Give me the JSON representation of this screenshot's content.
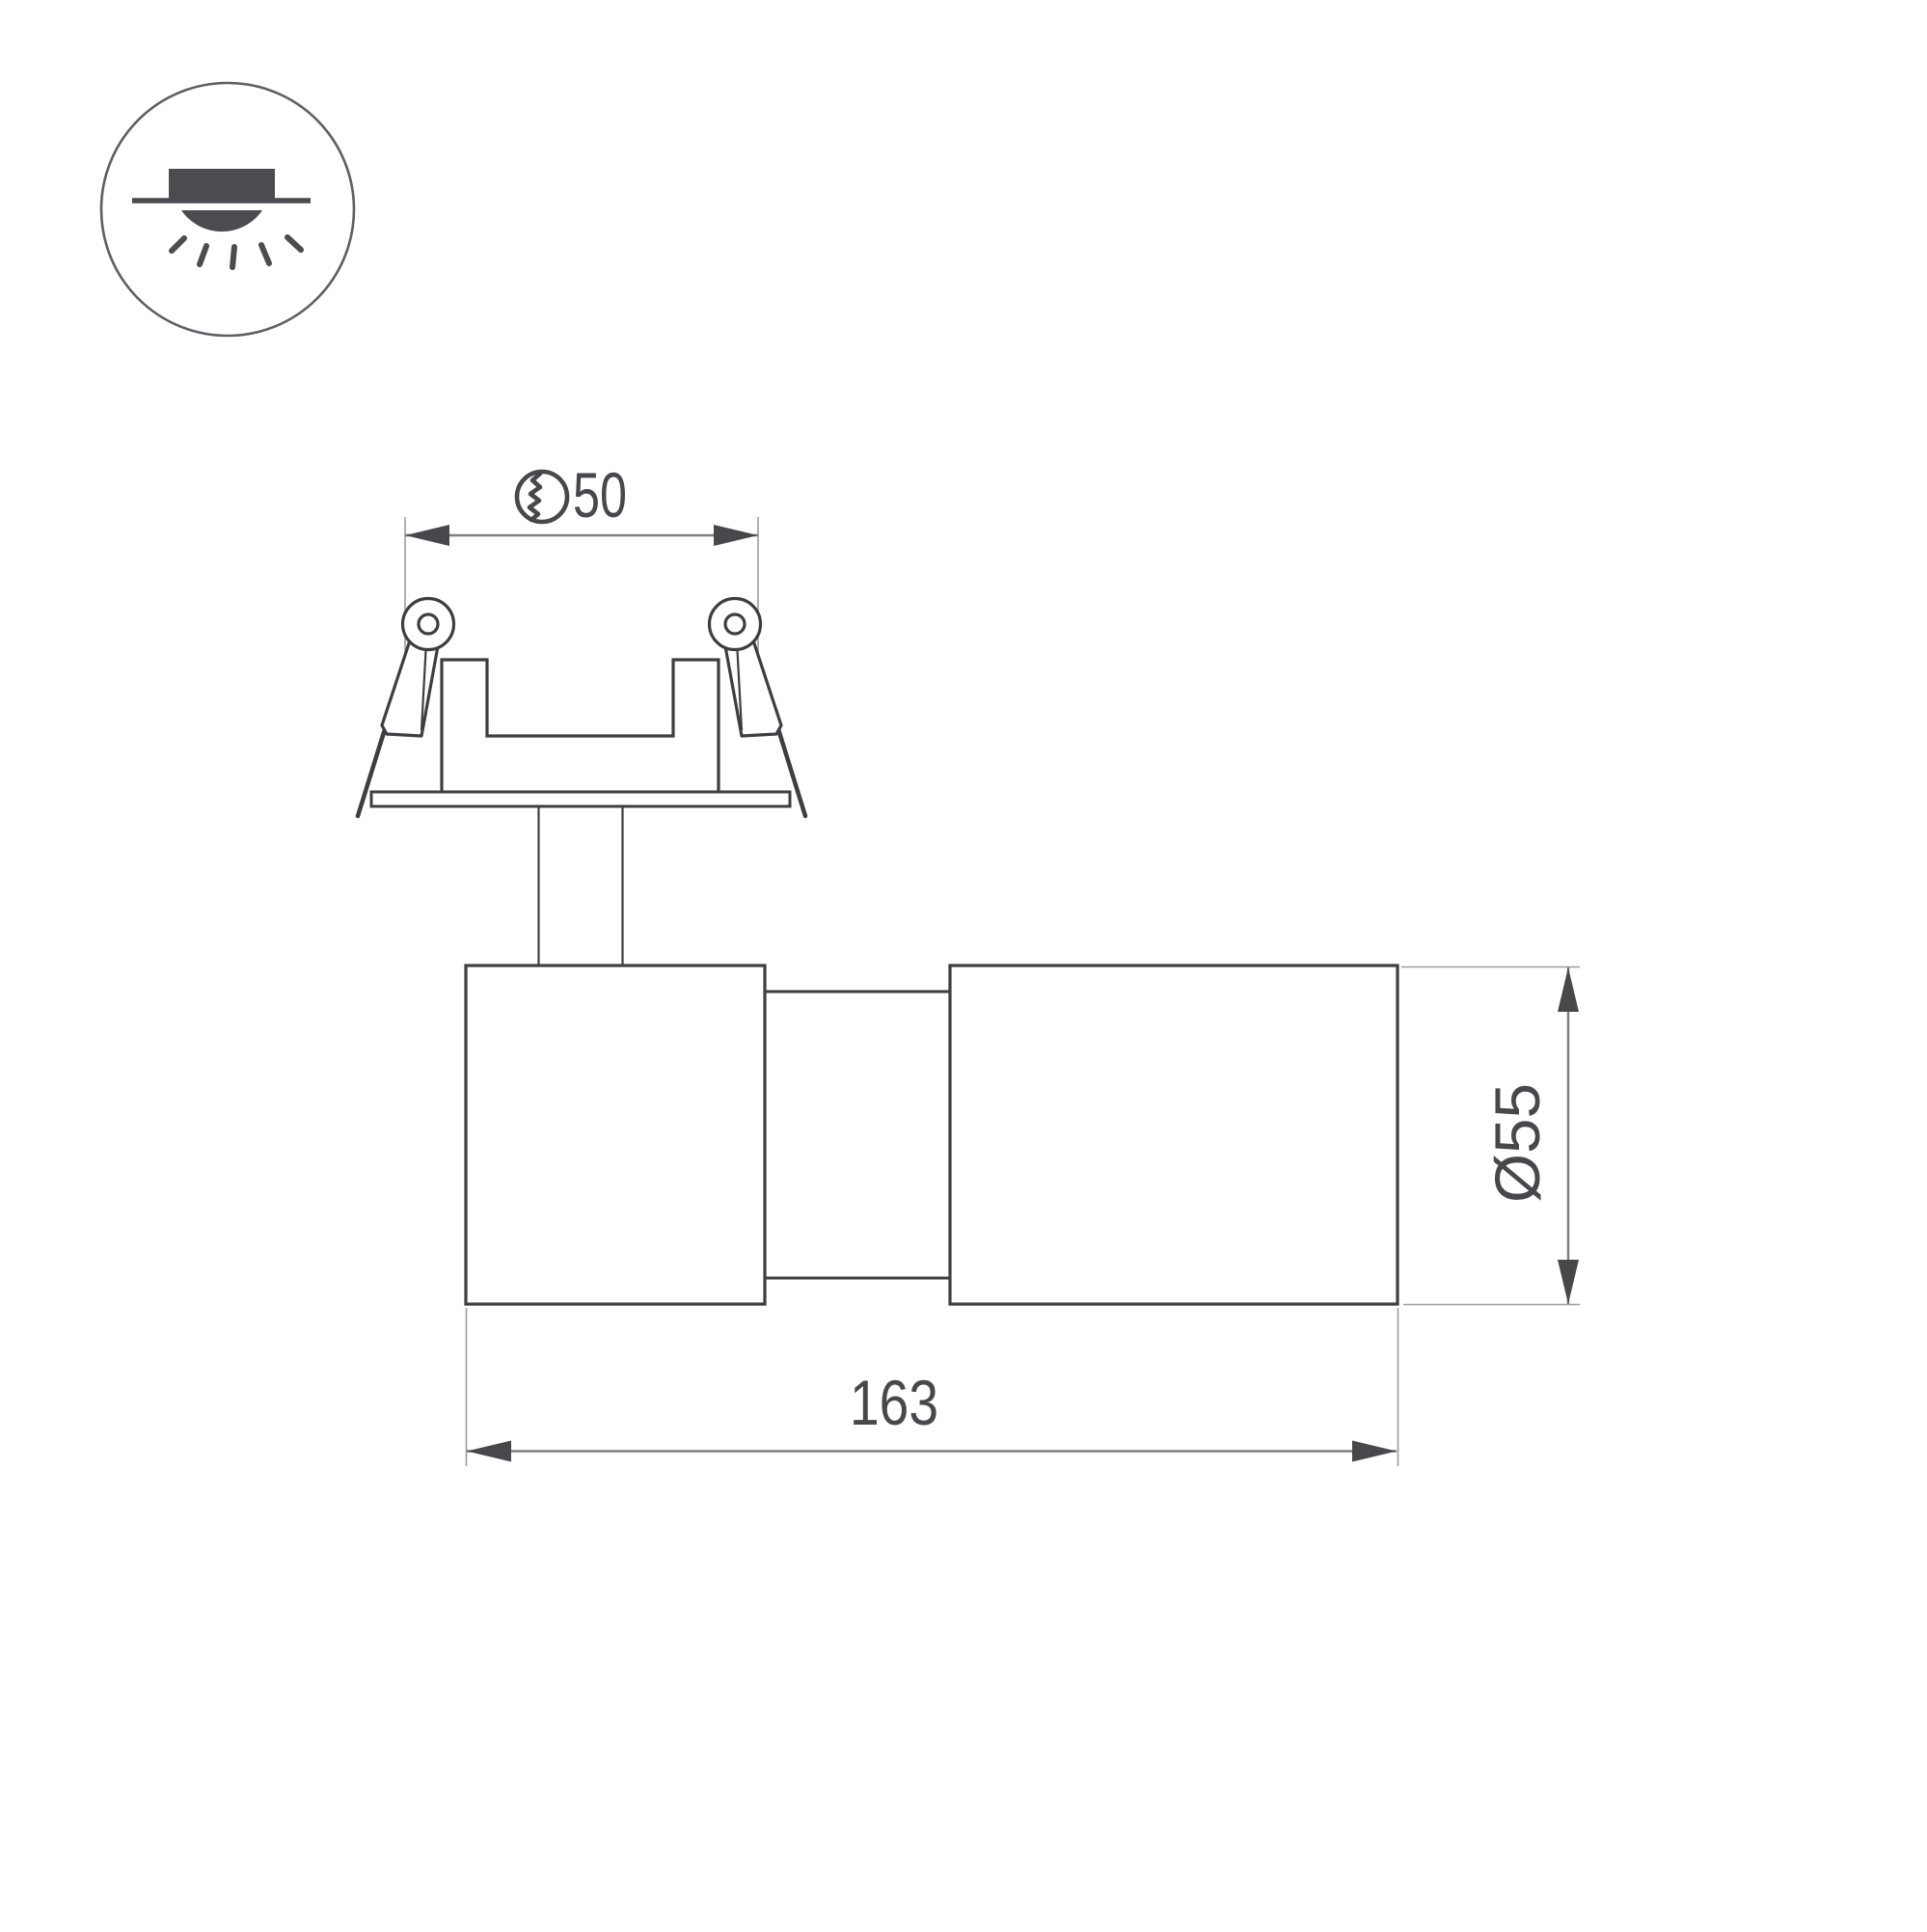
{
  "page": {
    "background": "#ffffff",
    "description": "Technical dimension drawing of a recessed adjustable spot luminaire"
  },
  "icon": {
    "name": "recessed-downlight-icon",
    "meaning": "recessed ceiling mounting with light emitting downward"
  },
  "dimensions": {
    "cutout": {
      "value": "50",
      "symbol": "drill-hole-diameter-symbol"
    },
    "length": {
      "value": "163"
    },
    "diameter": {
      "label": "Ø55"
    }
  },
  "colors": {
    "outline": "#3e3e42",
    "dimension_line": "#7e7e82",
    "extension_line": "#9c9ca0",
    "arrow_and_text": "#48484c",
    "icon_fill": "#4b4b50",
    "icon_circle_stroke": "#5e5e63"
  }
}
